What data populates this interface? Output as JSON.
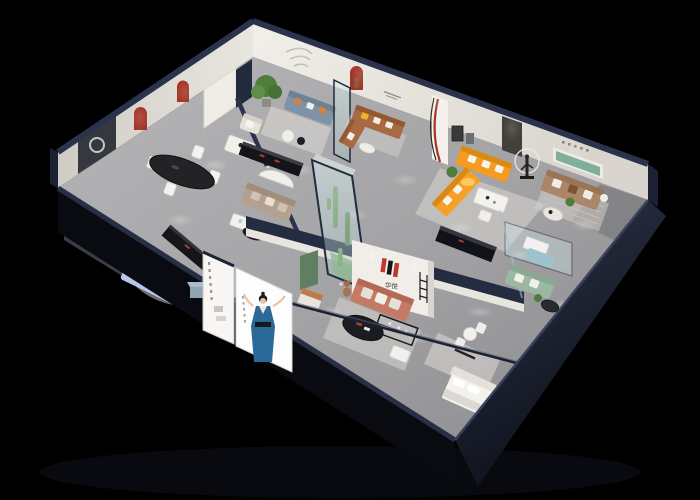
{
  "scene": {
    "kind": "3D isometric cutaway render",
    "subject": "furniture showroom floor plan, viewed from above at an angle on a black background",
    "background_color": "#000000",
    "wall_cut_color": "#2b334c",
    "floor_color": "#a7a6a8"
  },
  "brand": {
    "mark": "H",
    "name": "华悦",
    "mark_red": "#c0392b",
    "mark_dark": "#17171a",
    "location": "central feature wall"
  },
  "palette": {
    "exterior_navy": "#1f2636",
    "wall_white": "#eae7e2",
    "arch_red": "#a23527",
    "shelf_green": "#7fae9b",
    "sofa_orange": "#f39c1f",
    "sofa_brown": "#a86a43",
    "sofa_tan": "#ab8668",
    "sofa_salmon": "#c47a63",
    "sofa_periwinkle": "#b9c6ea",
    "sofa_bluegrey": "#7e94a6",
    "sofa_sage": "#9cb8a3",
    "sofa_teal": "#9ec3cf",
    "pillow_yellow": "#f0b429",
    "plant_green": "#4e7d3c",
    "poster_dress_blue": "#2a6a99"
  },
  "rooms": [
    {
      "id": "dining",
      "label": "dining vignette",
      "items": [
        "black oval dining table",
        "four white chairs",
        "two red arched wall niches",
        "dark feature panel with ring decor",
        "white cabinet"
      ]
    },
    {
      "id": "west-lounge",
      "label": "periwinkle sofa lounge",
      "items": [
        "light-blue fabric sofa set",
        "black media console",
        "round rug"
      ]
    },
    {
      "id": "north-lounge",
      "label": "north lounge",
      "items": [
        "potted tree",
        "cream armchair",
        "blue-grey sofa with orange pillows",
        "glass screen",
        "black sideboard with red accents",
        "curved white desk",
        "taupe sofa",
        "black oval coffee table",
        "white side tables"
      ]
    },
    {
      "id": "brown-corner",
      "label": "brown leather corner sofa vignette",
      "items": [
        "brown corner sofa",
        "yellow pillow",
        "red arch niche with teddy bear",
        "small wall slogan",
        "white coffee table"
      ]
    },
    {
      "id": "orange-suite",
      "label": "orange sectional vignette",
      "items": [
        "orange L-shaped sectional with white pillows",
        "white dining table and chairs",
        "striped curved display column",
        "framed wall art",
        "dark doorway"
      ]
    },
    {
      "id": "sculpture",
      "label": "sculpture display",
      "items": [
        "bronze figure statue",
        "illuminated ring light"
      ]
    },
    {
      "id": "east-lounge",
      "label": "tan sofa lounge",
      "items": [
        "tan three-seat sofa with white pillows",
        "green recessed wall shelf",
        "small wall characters",
        "round white coffee table",
        "potted plant",
        "striped rug"
      ]
    },
    {
      "id": "atrium",
      "label": "glass planter atrium",
      "items": [
        "tall glass enclosure with navy frame",
        "cactus plants",
        "moss and pebbles",
        "brown teddy-bear mannequin",
        "green wall panel"
      ]
    },
    {
      "id": "brand-wall",
      "label": "brand feature wall",
      "items": [
        "H logo mark",
        "华悦 wordmark",
        "ladder display shelf",
        "wall spotlights"
      ]
    },
    {
      "id": "salmon-suite",
      "label": "salmon sofa vignette",
      "items": [
        "salmon sofa with light cushions",
        "accent armchair",
        "black oval coffee table with red book",
        "black display stand",
        "white ottoman",
        "large rug"
      ]
    },
    {
      "id": "meeting-box",
      "label": "glass meeting box",
      "items": [
        "glass partition",
        "white table",
        "teal bench sofa",
        "sage-green sofa",
        "round black table",
        "potted plant"
      ]
    },
    {
      "id": "bedroom",
      "label": "bedroom vignette",
      "items": [
        "white bed with headboard",
        "striped rug",
        "round white table with chairs",
        "black clothes rack"
      ]
    }
  ],
  "exterior": {
    "walls": "navy-blue cut walls with dark outer faces",
    "screen_panel": {
      "background": "#f7f6f4",
      "content": "vertical column of small characters and thumbnails"
    },
    "model_poster": {
      "background": "#fdfdfd",
      "subject": "woman in a blue evening gown with black belt, arms raised",
      "side_text": "vertical small characters"
    },
    "ottoman_cube_color": "#8fa5b2"
  }
}
